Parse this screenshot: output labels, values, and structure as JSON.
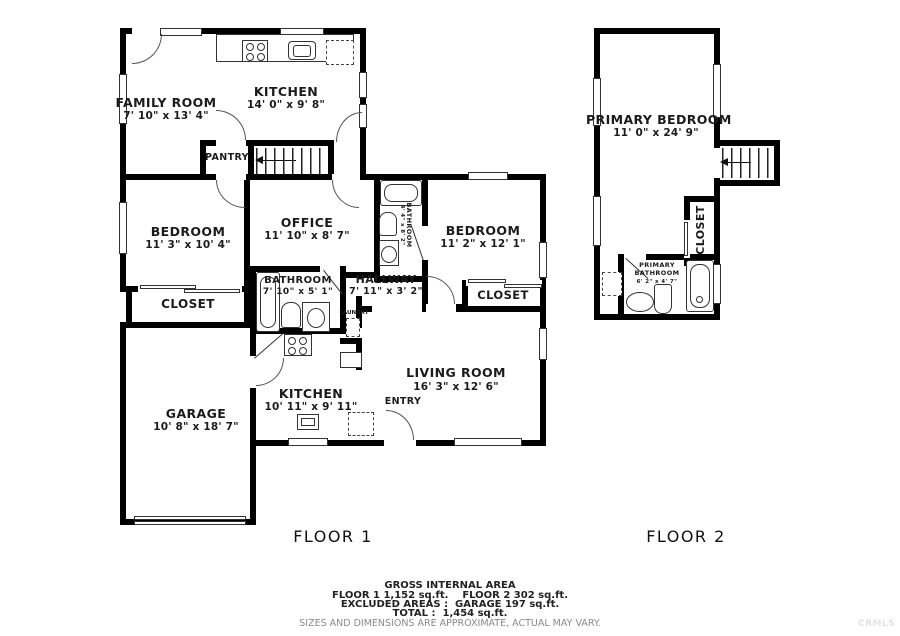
{
  "floor1": {
    "label": "FLOOR 1",
    "rooms": {
      "family_room": {
        "name": "FAMILY ROOM",
        "dims": "7' 10\" x 13' 4\""
      },
      "kitchen": {
        "name": "KITCHEN",
        "dims": "14' 0\" x 9' 8\""
      },
      "pantry": {
        "name": "PANTRY"
      },
      "bedroom_left": {
        "name": "BEDROOM",
        "dims": "11' 3\" x 10' 4\""
      },
      "office": {
        "name": "OFFICE",
        "dims": "11' 10\" x 8' 7\""
      },
      "bathroom_small": {
        "name": "BATHROOM",
        "dims": "4' 4\" x 8' 2\""
      },
      "bedroom_right": {
        "name": "BEDROOM",
        "dims": "11' 2\" x 12' 1\""
      },
      "closet_left": {
        "name": "CLOSET"
      },
      "closet_right": {
        "name": "CLOSET"
      },
      "bathroom_main": {
        "name": "BATHROOM",
        "dims": "7' 10\" x 5' 1\""
      },
      "hallway": {
        "name": "HALLWAY",
        "dims": "7' 11\" x 3' 2\""
      },
      "laundry": {
        "name": "LAUNDRY"
      },
      "garage": {
        "name": "GARAGE",
        "dims": "10' 8\" x 18' 7\""
      },
      "kitchen_lower": {
        "name": "KITCHEN",
        "dims": "10' 11\" x 9' 11\""
      },
      "living_room": {
        "name": "LIVING ROOM",
        "dims": "16' 3\" x 12' 6\""
      },
      "entry": {
        "name": "ENTRY"
      }
    }
  },
  "floor2": {
    "label": "FLOOR 2",
    "rooms": {
      "primary_bedroom": {
        "name": "PRIMARY BEDROOM",
        "dims": "11' 0\" x 24' 9\""
      },
      "closet": {
        "name": "CLOSET"
      },
      "primary_bathroom": {
        "name": "PRIMARY BATHROOM",
        "dims": "6' 2\" x 4' 7\""
      }
    }
  },
  "footer": {
    "title": "GROSS INTERNAL AREA",
    "line1": "FLOOR 1 1,152 sq.ft.    FLOOR 2 302 sq.ft.",
    "line2": "EXCLUDED AREAS :  GARAGE 197 sq.ft.",
    "line3": "TOTAL :  1,454 sq.ft.",
    "disclaimer": "SIZES AND DIMENSIONS ARE APPROXIMATE, ACTUAL MAY VARY.",
    "watermark": "CRMLS"
  }
}
